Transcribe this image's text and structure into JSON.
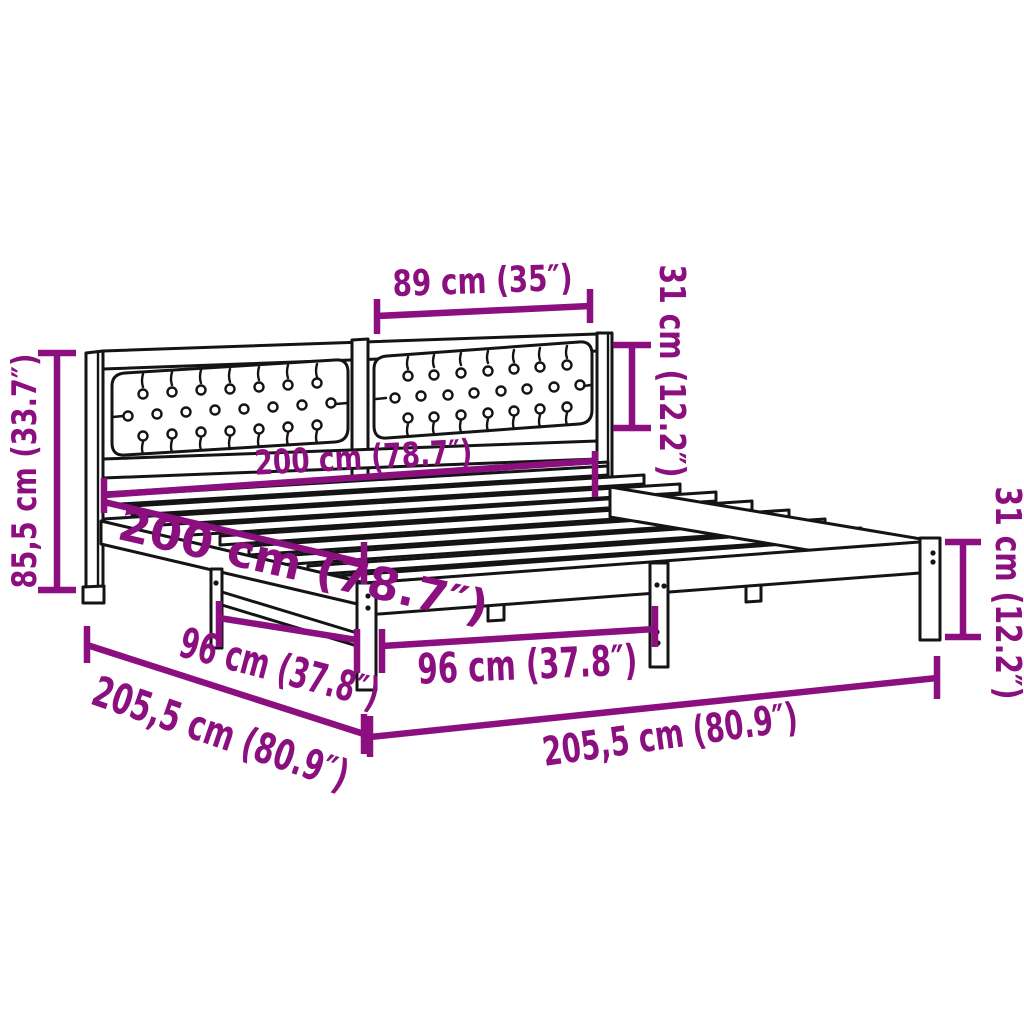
{
  "diagram": {
    "kind": "furniture-dimension-diagram",
    "subject": "bed-frame-with-upholstered-headboard",
    "colors": {
      "dimension_accent": "#8C0F80",
      "line_art": "#141414",
      "background": "#ffffff"
    },
    "dimensions": [
      {
        "id": "headboard-cushion-width",
        "label": "89 cm (35″)"
      },
      {
        "id": "headboard-cushion-height",
        "label": "31 cm (12.2″)"
      },
      {
        "id": "bed-width",
        "label": "200 cm (78.7″)"
      },
      {
        "id": "bed-length",
        "label": "200 cm (78.7″)"
      },
      {
        "id": "overall-height",
        "label": "85,5 cm (33.7″)"
      },
      {
        "id": "side-rail-leg-spacing",
        "label": "96 cm (37.8″)"
      },
      {
        "id": "front-rail-leg-spacing",
        "label": "96 cm (37.8″)"
      },
      {
        "id": "overall-length",
        "label": "205,5 cm (80.9″)"
      },
      {
        "id": "overall-width",
        "label": "205,5 cm (80.9″)"
      },
      {
        "id": "frame-height",
        "label": "31 cm (12.2″)"
      }
    ]
  }
}
